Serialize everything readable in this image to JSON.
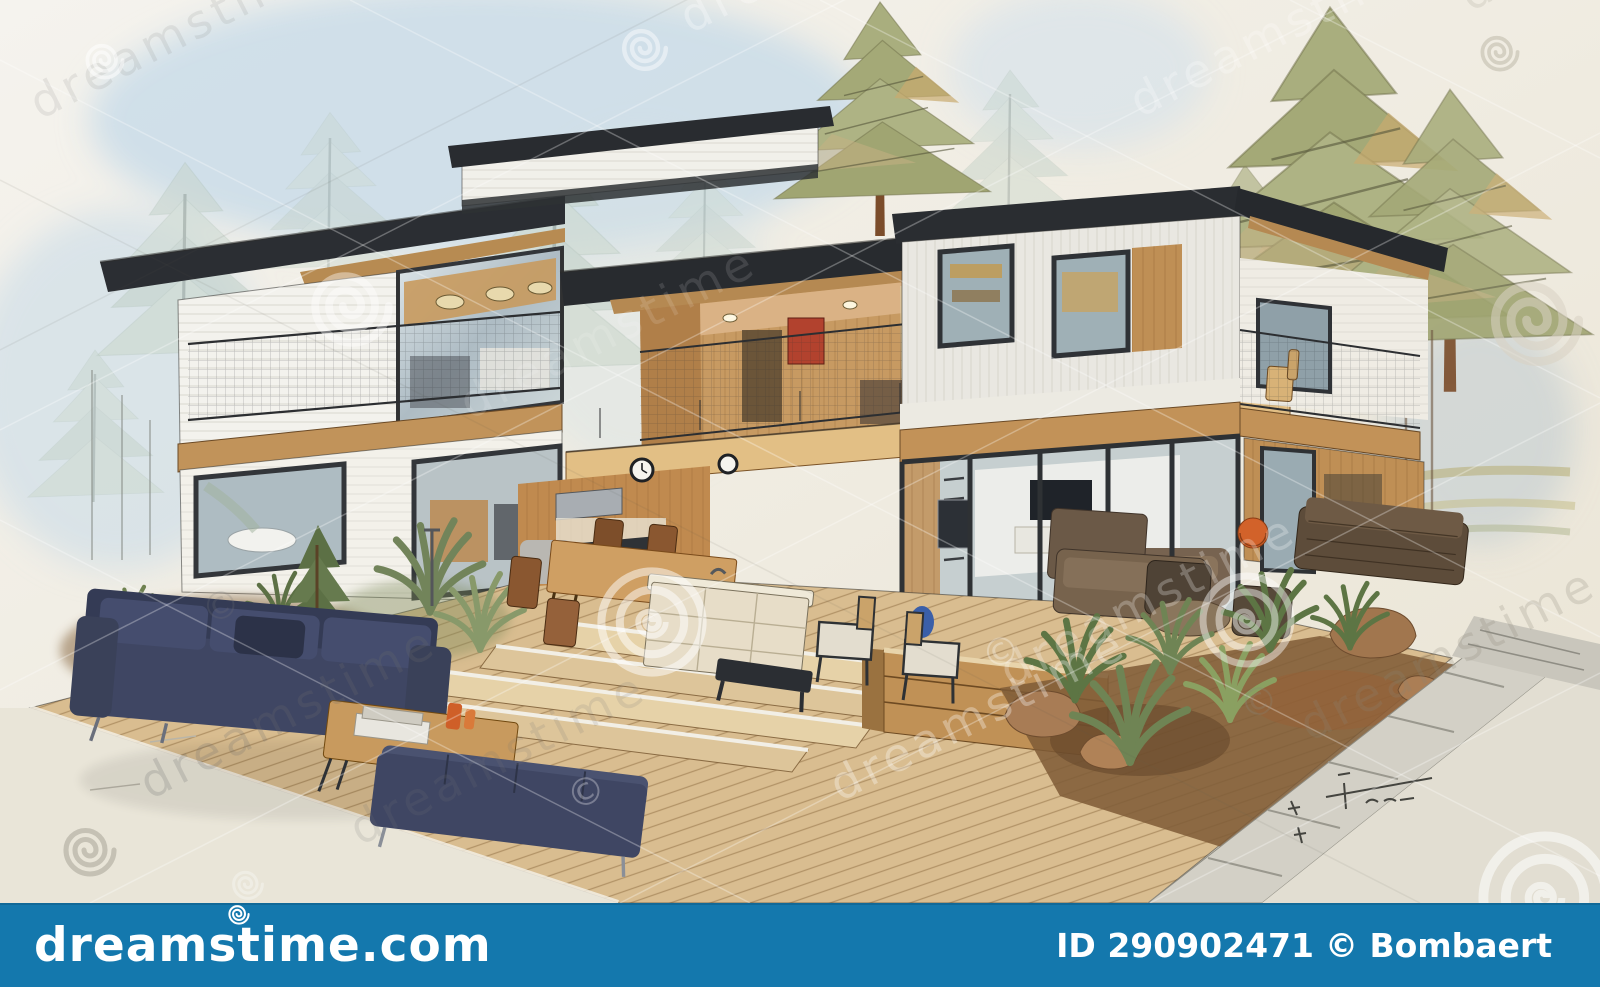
{
  "image": {
    "alt": "Watercolor and ink architectural concept sketch of a modern flat-roof two-story house with cut-away interiors, wooden terrace, navy outdoor sofas, pine trees and landscaped garden"
  },
  "watermark": {
    "brand": "dreamstime",
    "copyright_symbol": "©"
  },
  "footer": {
    "site": "dreamstime.com",
    "credit_id": "ID 290902471",
    "credit_author": "© Bombaert",
    "bar_color": "#1478ad",
    "text_color": "#ffffff"
  },
  "palette": {
    "paper": "#efebe0",
    "roof_charcoal": "#2b2e33",
    "wood_tan": "#c49058",
    "deck_wood": "#d9bd90",
    "navy_sofa": "#3f4663",
    "pine_olive": "#a9ae7e",
    "sky_wash": "#c7dbe9",
    "accent_orange": "#d2622a",
    "watermark_bar_blue": "#1478ad"
  }
}
